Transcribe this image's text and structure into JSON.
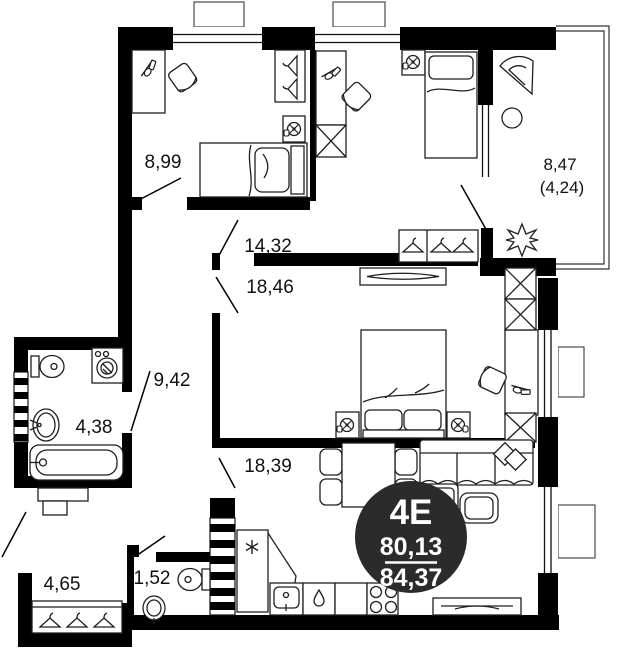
{
  "page": {
    "background": "#ffffff"
  },
  "plan": {
    "badge": {
      "unit_label": "4E",
      "living_area": "80,13",
      "total_area": "84,37"
    },
    "room_areas": {
      "bedroom_small": "8,99",
      "bedroom_middle": "14,32",
      "bedroom_master": "18,46",
      "hallway": "9,42",
      "bathroom": "4,38",
      "living_kitchen": "18,39",
      "entry_hall": "4,65",
      "wc": "1,52",
      "balcony": "8,47",
      "balcony_coeff": "(4,24)"
    },
    "colors": {
      "walls": "#000000",
      "furniture_line": "#1f1f1f",
      "badge_bg": "#2b2b2b",
      "badge_text": "#ffffff",
      "label_text": "#111111"
    }
  }
}
